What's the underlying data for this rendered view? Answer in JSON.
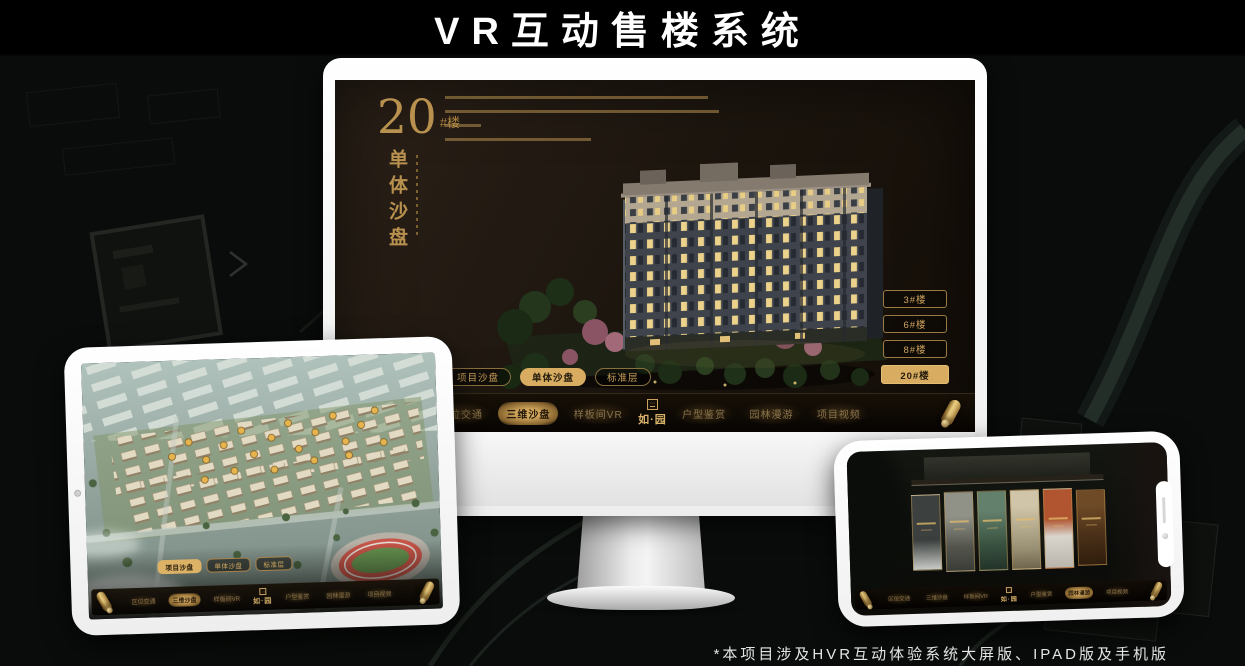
{
  "page": {
    "title": "VR互动售楼系统",
    "footnote": "*本项目涉及HVR互动体验系统大屏版、IPAD版及手机版"
  },
  "colors": {
    "gold": "#d2a65c",
    "gold_bright": "#e8c87a",
    "active_tab_bg": "#d8ad62",
    "screen_brown": "#1e1710",
    "nav_black": "#0b0805"
  },
  "monitor": {
    "heading": {
      "number": "20",
      "suffix": "#楼",
      "subtitle_vertical": "单体沙盘"
    },
    "floor_buttons": [
      {
        "label": "3#楼",
        "active": false
      },
      {
        "label": "6#楼",
        "active": false
      },
      {
        "label": "8#楼",
        "active": false
      },
      {
        "label": "20#楼",
        "active": true
      }
    ],
    "view_tabs": [
      {
        "label": "项目沙盘",
        "active": false
      },
      {
        "label": "单体沙盘",
        "active": true
      },
      {
        "label": "标准层",
        "active": false
      }
    ],
    "nav": {
      "items": [
        {
          "label": "区位交通",
          "active": false
        },
        {
          "label": "三维沙盘",
          "active": true
        },
        {
          "label": "样板间VR",
          "active": false
        },
        {
          "label": "户型鉴赏",
          "active": false
        },
        {
          "label": "园林漫游",
          "active": false
        },
        {
          "label": "项目视频",
          "active": false
        }
      ],
      "logo": "如·园"
    }
  },
  "tablet": {
    "view_tabs": [
      {
        "label": "项目沙盘",
        "active": true
      },
      {
        "label": "单体沙盘",
        "active": false
      },
      {
        "label": "标准层",
        "active": false
      }
    ],
    "nav": {
      "items": [
        {
          "label": "区位交通",
          "active": false
        },
        {
          "label": "三维沙盘",
          "active": true
        },
        {
          "label": "样板间VR",
          "active": false
        },
        {
          "label": "户型鉴赏",
          "active": false
        },
        {
          "label": "园林漫游",
          "active": false
        },
        {
          "label": "项目视频",
          "active": false
        }
      ],
      "logo": "如·园"
    }
  },
  "phone": {
    "nav": {
      "items": [
        {
          "label": "区位交通",
          "active": false
        },
        {
          "label": "三维沙盘",
          "active": false
        },
        {
          "label": "样板间VR",
          "active": false
        },
        {
          "label": "户型鉴赏",
          "active": false
        },
        {
          "label": "园林漫游",
          "active": true
        },
        {
          "label": "项目视频",
          "active": false
        }
      ],
      "logo": "如·园"
    }
  }
}
